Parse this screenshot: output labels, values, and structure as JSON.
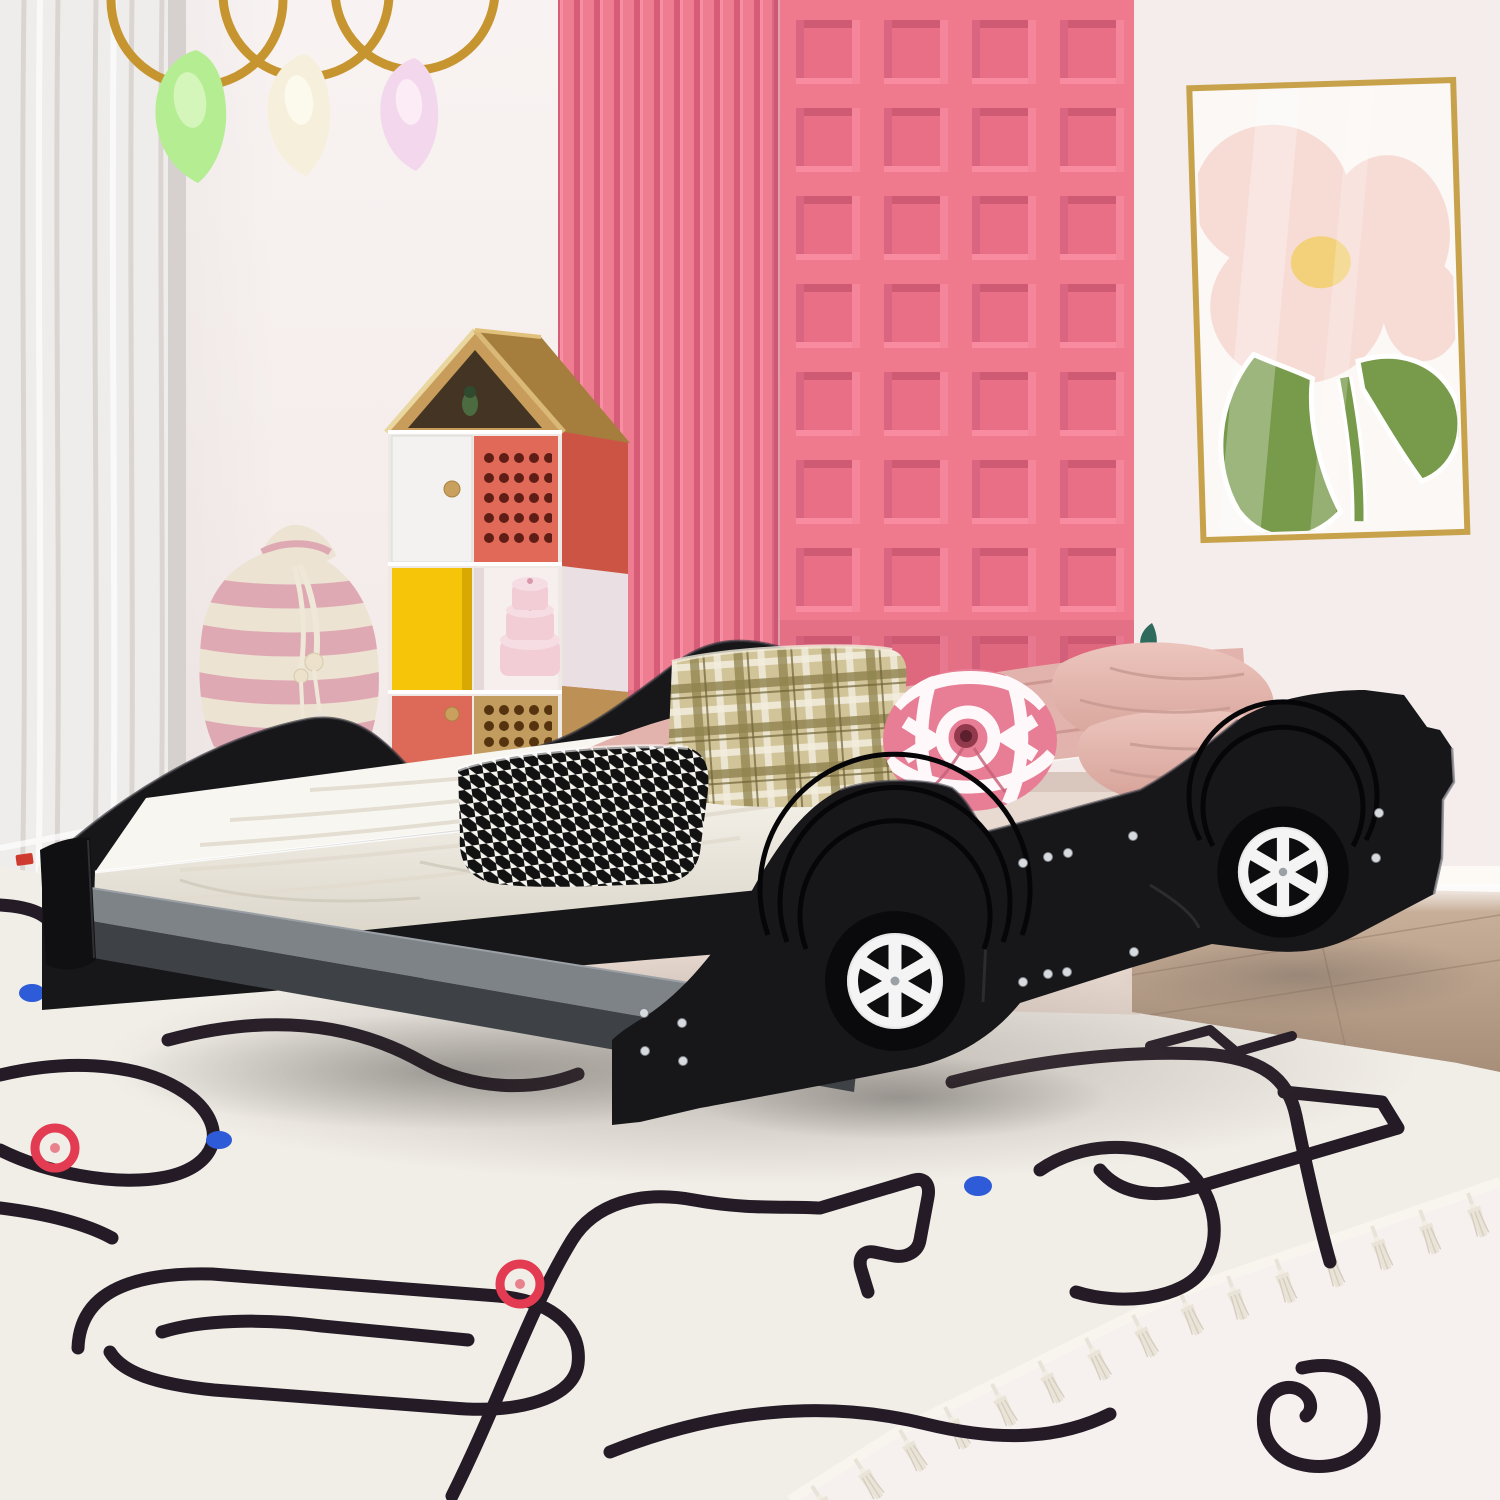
{
  "meta": {
    "description": "Product photo of a kids bedroom: a black race-car shaped platform bed with white spoked wheels and silver rivets, white mattress with pink sheet and pillows (houndstooth, plaid, round pink, satin pink), in front of a pink fluted-and-coffered accent wall, a house-shaped storage cubby, a striped drawstring bag, gold hoops with fabric leaves, a framed flower print, and a white race-track rug with tassels over a wood floor."
  },
  "objects": [
    "white sheer curtain",
    "gold hanging hoops with green, cream and pink fabric leaves",
    "pink vertical slat accent panel",
    "pink coffered square-grid accent panel",
    "framed pink flower artwork in gold frame",
    "house-shaped storage shelf with colored doors",
    "pink striped drawstring bag",
    "black race-car platform bed",
    "white six-spoke wheels",
    "silver rivets",
    "white mattress",
    "pink sheet",
    "houndstooth pillow",
    "plaid pillow",
    "round pink tufted pillow",
    "pink satin pillows",
    "gray running board",
    "white race-track area rug with tassels",
    "red and blue track dots",
    "wood flooring",
    "small toy blocks"
  ],
  "palette": {
    "wall": "#f6f0ef",
    "wall_right": "#f4edeb",
    "curtain": "#efedeb",
    "gold": "#c6952f",
    "pink_slat": "#ee7d92",
    "pink_grid": "#ef7a8e",
    "art_frame": "#c8a24b",
    "art_bg": "#fbf8f5",
    "flower_pink": "#f7dcd6",
    "flower_core": "#f2cf6b",
    "leaf_green": "#789a4b",
    "roof_wood": "#c89d5b",
    "roof_side": "#a57e3e",
    "roof_inner": "#433423",
    "door_white": "#f3f2f0",
    "door_coral": "#e06a57",
    "door_yellow": "#f6c50a",
    "door_wood": "#c29b5e",
    "hole_coral": "#5e1d15",
    "hole_wood": "#55330f",
    "knob_wood": "#caa05e",
    "box_pink": "#f2cdd6",
    "bag_cream": "#ece3d2",
    "bag_pink": "#dfa9b4",
    "rope": "#efe8d8",
    "bed_black": "#17171a",
    "endcap": "#101012",
    "step_top": "#7e8388",
    "step_front": "#3e4246",
    "wheel_white": "#f4f4f4",
    "wheel_hub": "#9aa0a6",
    "rivet": "#d7dbe0",
    "mattress_top": "#f8f6f1",
    "sheet": "#e2b3ac",
    "sheet_fold": "#c8928c",
    "plaid_base": "#d2c499",
    "plaid_olive": "#8f824d",
    "round_pillow": "#e87e95",
    "round_dark": "#93394d",
    "satin_hi": "#ecc5bd",
    "satin_lo": "#d5a096",
    "sprig": "#2f6b5c",
    "floor_back": "#e9dad1",
    "floor_corner": "#ecd9d1",
    "floor_right_hi": "#cdb49e",
    "floor_right_lo": "#a68e79",
    "baseboard": "#fdfaf6",
    "rug": "#f1eee7",
    "rug_line": "#241b26",
    "rug_red": "#e23b52",
    "rug_blue": "#2e5bd7",
    "tassel": "#eae4d8"
  }
}
